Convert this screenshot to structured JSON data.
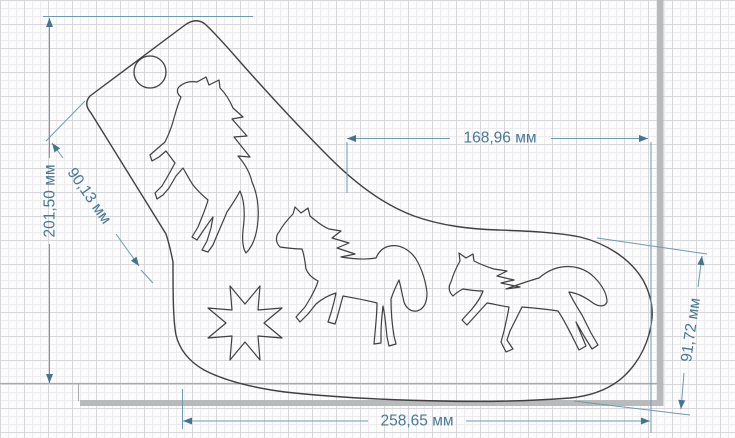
{
  "drawing": {
    "title": "sock-blocker-template-sketch",
    "units": "мм",
    "shapes": {
      "sock_outline": "sock-shaped template with rounded cuff",
      "hanging_hole": "round hanging hole in cuff",
      "cutout_1": "rearing horse silhouette",
      "cutout_2": "trotting horse silhouette",
      "cutout_3": "galloping horse silhouette",
      "cutout_4": "eight-pointed star"
    }
  },
  "dimensions": {
    "height_left": {
      "label": "201,50 мм"
    },
    "cuff_diagonal": {
      "label": "90,13 мм"
    },
    "top_width": {
      "label": "168,96 мм"
    },
    "bottom_length": {
      "label": "258,65 мм"
    },
    "toe_height": {
      "label": "91,72 мм"
    }
  },
  "colors": {
    "outline": "#3f3f3f",
    "dimension_line": "#6e9aab",
    "dimension_text": "#4a7890",
    "arrow": "#46748c",
    "grid_minor": "#ececee",
    "grid_major": "#d7d7db",
    "sheet_shadow": "#b9babc",
    "sheet_edge": "#a8abae",
    "background": "#fcfcfd"
  }
}
